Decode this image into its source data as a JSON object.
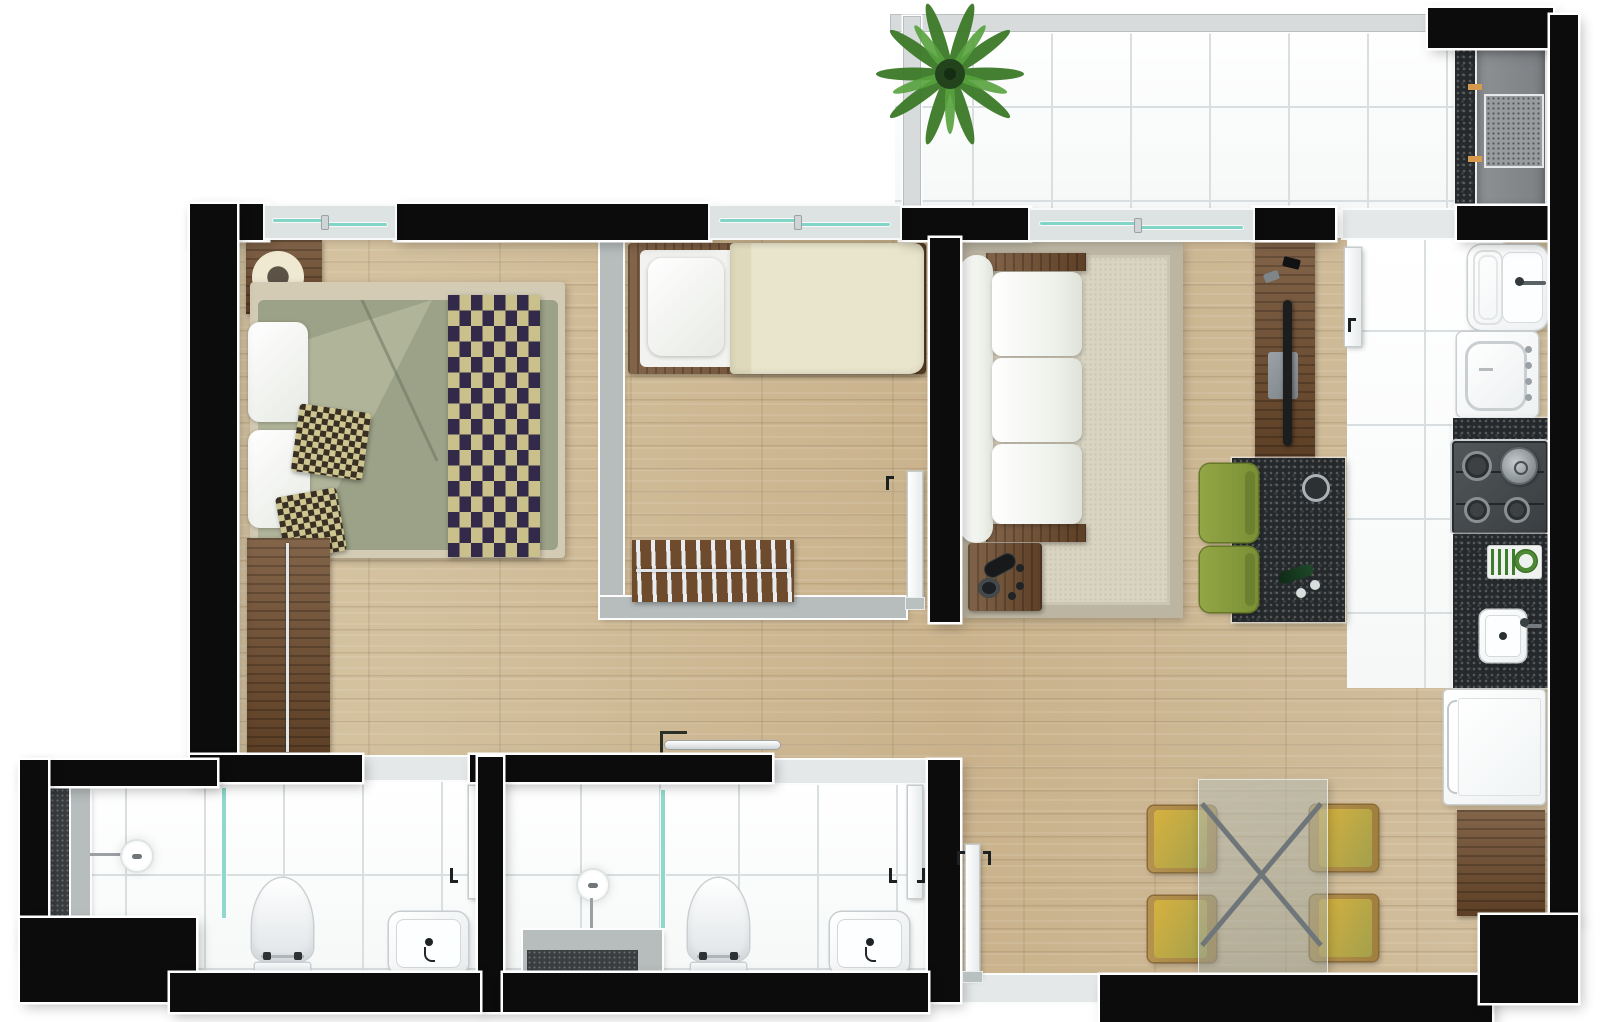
{
  "document": {
    "kind": "apartment-floor-plan-rendering",
    "visible_text": []
  },
  "rooms": [
    {
      "id": "balcony",
      "features": [
        "tile-floor",
        "glass-railing",
        "potted-palm-plant",
        "granite-counter",
        "barbecue-grill"
      ]
    },
    {
      "id": "master-bedroom",
      "features": [
        "double-bed",
        "sage-duvet",
        "checkered-runner",
        "checkered-cushions",
        "white-pillows",
        "nightstand",
        "round-table-lamp",
        "open-wardrobe-hangers",
        "window"
      ]
    },
    {
      "id": "second-bedroom",
      "features": [
        "single-bed",
        "white-pillow",
        "cream-duvet",
        "open-hanger-rack",
        "door",
        "window"
      ]
    },
    {
      "id": "living-room",
      "features": [
        "three-seat-sofa",
        "area-rug",
        "side-table",
        "remote-controls",
        "tv-panel",
        "tv",
        "media-shelf",
        "breakfast-bar",
        "bar-stools",
        "fruit-bowl",
        "wine-bottle",
        "window-to-balcony"
      ]
    },
    {
      "id": "kitchen",
      "features": [
        "pass-through-counter",
        "service-door",
        "laundry-tub",
        "washing-machine",
        "granite-counter",
        "gas-cooktop",
        "pot",
        "dish-rack",
        "counter-sink",
        "refrigerator",
        "base-cabinet",
        "tile-floor"
      ]
    },
    {
      "id": "dining-area",
      "features": [
        "glass-dining-table",
        "x-base",
        "dining-chairs",
        "entry-door",
        "entry-threshold"
      ]
    },
    {
      "id": "bathroom-1",
      "features": [
        "shower-niche",
        "shower-ledge",
        "shower-head",
        "glass-partition",
        "toilet",
        "washbasin",
        "door",
        "tile-floor"
      ]
    },
    {
      "id": "bathroom-2",
      "features": [
        "shower-head",
        "vanity-counter",
        "bath-mat",
        "glass-partition",
        "toilet",
        "washbasin",
        "door",
        "towel-bar",
        "tile-floor"
      ]
    }
  ],
  "counts": {
    "dining_chairs": 4,
    "bar_stools": 2,
    "bathrooms": 2,
    "bedrooms": 2,
    "cooktop_burners": 4
  },
  "palette": {
    "wall": "#0c0c0d",
    "wall_outline": "#ffffff",
    "wood_floor": "#cfbb98",
    "tile_floor": "#fcfdfd",
    "tile_grid": "#d9dee0",
    "granite": "#26292c",
    "window_glass_teal": "#82d4c6",
    "partition_gray": "#b7bdbd",
    "bedding_sage": "#9ca287",
    "bedding_cream": "#e9e5cc",
    "checker_gold": "#c9c08c",
    "checker_navy": "#332a49",
    "sofa_white": "#f2f4ee",
    "rug_beige": "#d9d3c1",
    "rug_border": "#bcb5a2",
    "furniture_wood": "#6e4b2c",
    "bar_stool_green": "#85983c",
    "dining_seat_mustard": "#cfa83e",
    "plant_green": "#4a8c33",
    "appliance_white": "#fbfcfc",
    "grill_gray": "#85898c",
    "grill_hinge_orange": "#d69a4e"
  }
}
